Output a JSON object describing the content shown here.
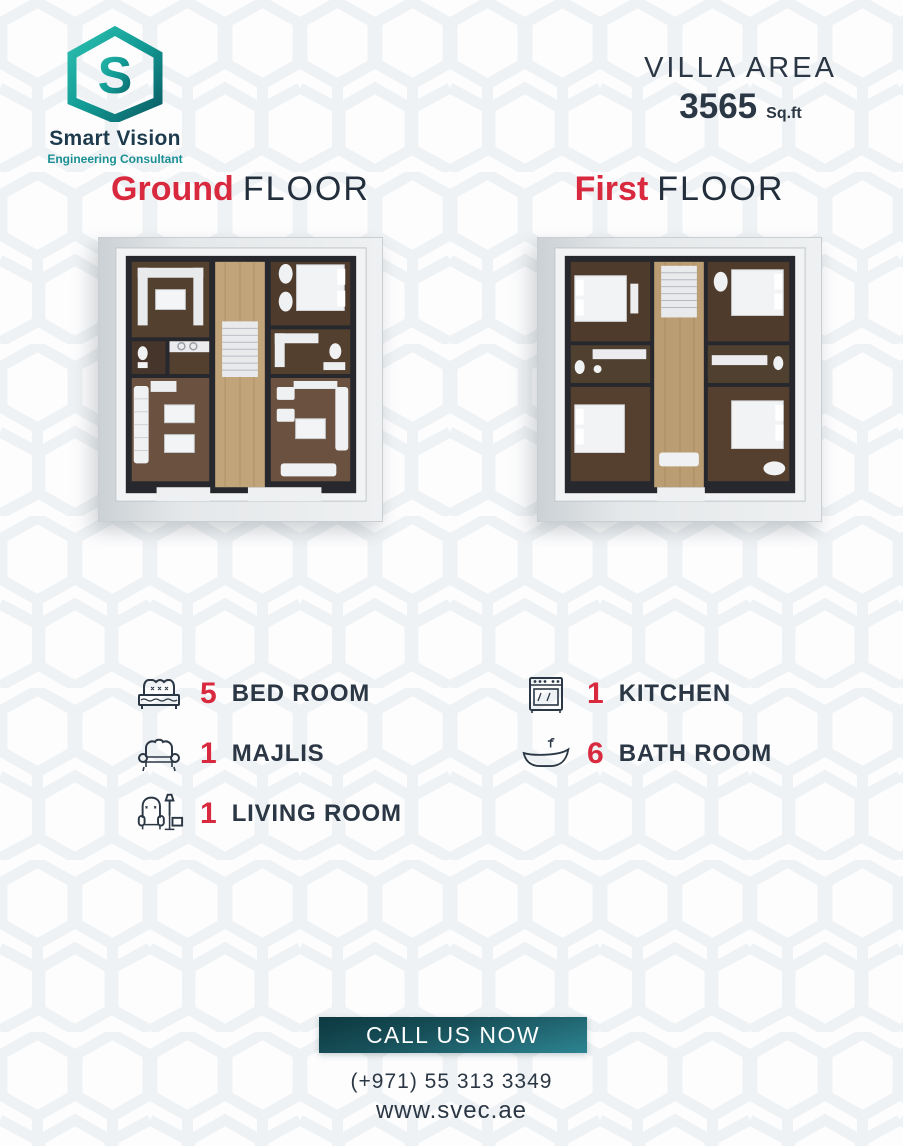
{
  "brand": {
    "name": "Smart Vision",
    "tagline": "Engineering Consultant",
    "logo_icon": "hexagon-s-logo",
    "logo_color_dark": "#0b5c64",
    "logo_color_light": "#2cc0b0"
  },
  "villa_area": {
    "label": "VILLA AREA",
    "value": "3565",
    "unit": "Sq.ft"
  },
  "floors": [
    {
      "accent": "Ground",
      "rest": "FLOOR",
      "plan": "ground-floor-plan"
    },
    {
      "accent": "First",
      "rest": "FLOOR",
      "plan": "first-floor-plan"
    }
  ],
  "features": {
    "left": [
      {
        "icon": "bed-icon",
        "count": "5",
        "label": "BED ROOM"
      },
      {
        "icon": "sofa-icon",
        "count": "1",
        "label": "MAJLIS"
      },
      {
        "icon": "armchair-icon",
        "count": "1",
        "label": "LIVING ROOM"
      }
    ],
    "right": [
      {
        "icon": "stove-icon",
        "count": "1",
        "label": "KITCHEN"
      },
      {
        "icon": "bathtub-icon",
        "count": "6",
        "label": "BATH ROOM"
      }
    ]
  },
  "cta": {
    "label": "CALL US NOW"
  },
  "contact": {
    "phone": "(+971) 55 313 3349",
    "website": "www.svec.ae"
  },
  "colors": {
    "accent_red": "#d8293e",
    "dark_navy": "#2b3744",
    "teal_dark": "#0c3840",
    "teal_light": "#2d8492",
    "pattern_gray": "#eff2f4"
  }
}
